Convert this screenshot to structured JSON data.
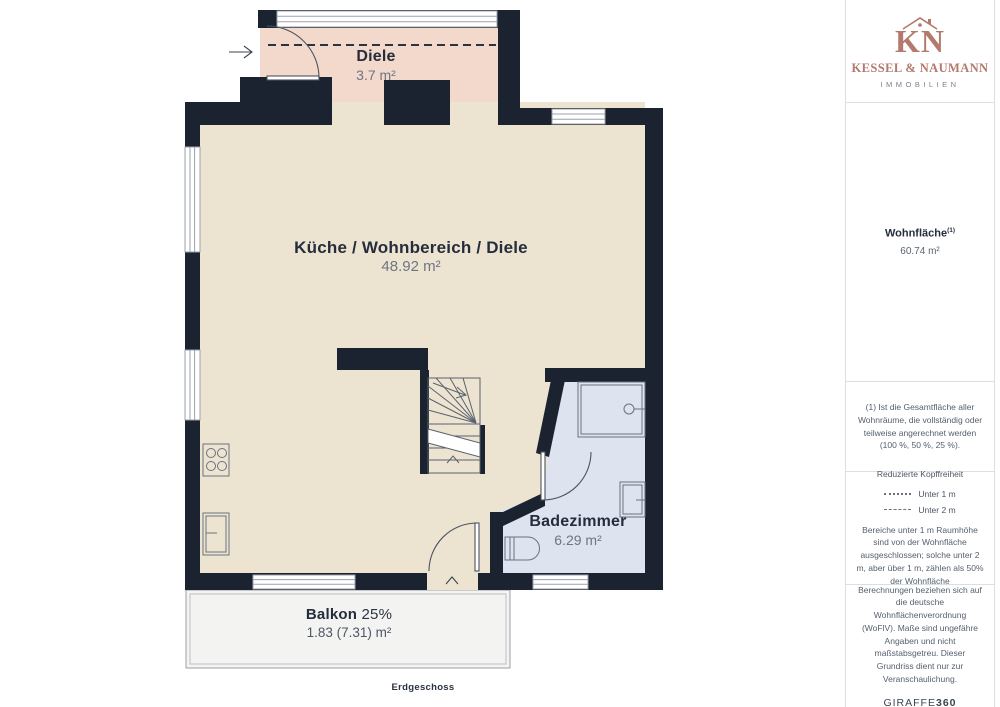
{
  "brand": {
    "monogram": "KN",
    "name": "KESSEL & NAUMANN",
    "division": "IMMOBILIEN"
  },
  "sidebar": {
    "area_title": "Wohnfläche",
    "area_title_footnote_marker": "(1)",
    "area_value": "60.74 m²",
    "footnote": "(1) Ist die Gesamtfläche aller Wohnräume, die vollständig oder teilweise angerechnet werden (100 %, 50 %, 25 %).",
    "headroom_title": "Reduzierte Kopffreiheit",
    "headroom_legend": [
      {
        "style": "dotted",
        "label": "Unter 1 m"
      },
      {
        "style": "dashed",
        "label": "Unter 2 m"
      }
    ],
    "headroom_note": "Bereiche unter 1 m Raumhöhe sind von der Wohnfläche ausgeschlossen; solche unter 2 m, aber über 1 m, zählen als 50% der Wohnfläche",
    "disclaimer": "Berechnungen beziehen sich auf die deutsche Wohnflächenverordnung (WoFlV). Maße sind ungefähre Angaben und nicht maßstabsgetreu. Dieser Grundriss dient nur zur Veranschaulichung.",
    "provider_name": "GIRAFFE",
    "provider_suffix": "360"
  },
  "floorplan": {
    "floor_label": "Erdgeschoss",
    "rooms": {
      "diele": {
        "name": "Diele",
        "area": "3.7 m²"
      },
      "living": {
        "name": "Küche / Wohnbereich / Diele",
        "area": "48.92 m²"
      },
      "bath": {
        "name": "Badezimmer",
        "area": "6.29 m²"
      },
      "balcony": {
        "name": "Balkon",
        "percent": "25%",
        "area": "1.83 (7.31) m²"
      }
    },
    "colors": {
      "wall": "#1b2330",
      "diele": "#f2d9cc",
      "living": "#ece4d1",
      "bath": "#dde3ef",
      "balcony": "#f3f3f2",
      "brand": "#b2796c"
    }
  }
}
